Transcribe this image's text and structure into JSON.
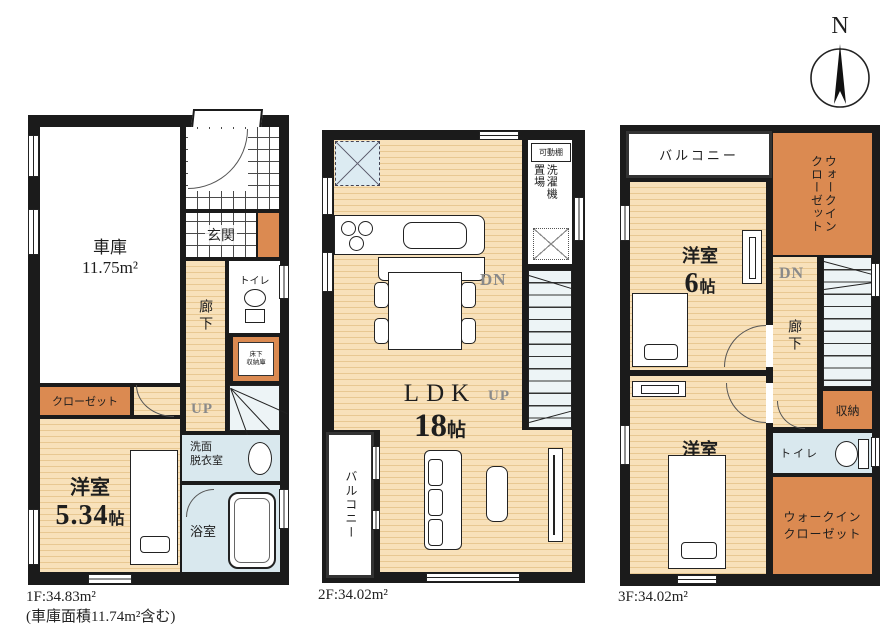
{
  "compass": {
    "north_label": "N"
  },
  "floor1": {
    "caption": {
      "line1": "1F:34.83m²",
      "line2": "(車庫面積11.74m²含む)"
    },
    "garage": {
      "name": "車庫",
      "area": "11.75m²"
    },
    "entrance": "玄関",
    "toilet": "トイレ",
    "corridor": "廊下",
    "underfloor_storage": "床下\n収納庫",
    "stairs_label": "UP",
    "closet": "クローゼット",
    "washroom": "洗面\n脱衣室",
    "bathroom": "浴室",
    "bedroom": {
      "name": "洋室",
      "size_num": "5.34",
      "size_unit": "帖"
    }
  },
  "floor2": {
    "caption": "2F:34.02m²",
    "movable_shelf": "可動棚",
    "laundry": "洗濯機\n置場",
    "dn_label": "DN",
    "up_label": "UP",
    "ldk": {
      "name": "LDK",
      "size_num": "18",
      "size_unit": "帖"
    },
    "balcony": "バルコニー"
  },
  "floor3": {
    "caption": "3F:34.02m²",
    "balcony": "バルコニー",
    "wic_top": "ウォークイン\nクローゼット",
    "bedroom1": {
      "name": "洋室",
      "size_num": "6",
      "size_unit": "帖"
    },
    "dn_label": "DN",
    "corridor": "廊下",
    "storage": "収納",
    "toilet": "トイレ",
    "wic_bottom": "ウォークイン\nクローゼット",
    "bedroom2": {
      "name": "洋室",
      "size_num": "6",
      "size_unit": "帖"
    }
  },
  "colors": {
    "floor_beige": "#F6D7A3",
    "accent_orange": "#DB8A51",
    "wet_blue": "#D9E8EE",
    "wall": "#1B1B1B"
  }
}
